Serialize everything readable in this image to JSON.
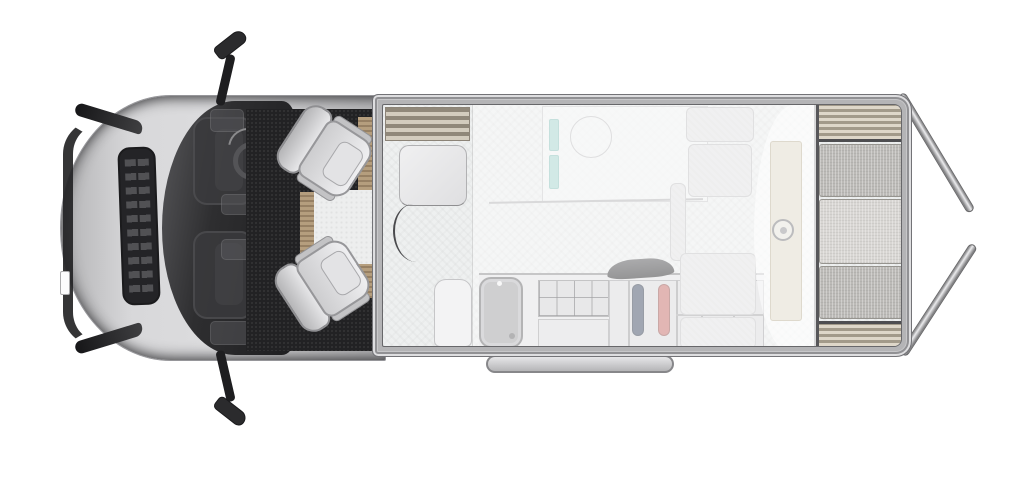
{
  "meta": {
    "description": "Top-down floor plan of a campervan motorhome, front facing left, rear doors open on the right"
  },
  "palette": {
    "background": "#ffffff",
    "body_frame": "#b4b4b6",
    "cab_silver": "#d3d3d5",
    "glass_dark": "#2a2a2c",
    "carpet_dark": "#222224",
    "floor_light": "#eef0f0",
    "furniture_light": "#e7e7e8",
    "wood_tan": "#b59e7e",
    "shelf_wood": "#c6bfb1",
    "mattress_gray": "#bcbab7",
    "mattress_light": "#d8d6d3",
    "teal_accent": "#a9d6d1",
    "blue_accent": "#445068",
    "red_accent": "#c9706c",
    "cream_panel": "#efece4",
    "overlay_white": "rgba(252,252,252,0.5)"
  },
  "regions": {
    "cab": "driver cab with two swivel seats facing the lounge",
    "lounge": "front lounge with table and curved bench",
    "entry": "side entry door step with wooden treads",
    "bathroom": "washroom with shower ring and teal rails",
    "kitchen": "kitchen block with sink, two-zone hob and storage cabinet",
    "gas_locker": "locker with blue and red bottles",
    "bedroom": "rear bed with mattress sections and wood shelves",
    "drop_down_bed": "translucent drop-down bed overlay with roof fan",
    "rear_doors": "rear doors shown open",
    "exterior_step": "sliding entry step under the body",
    "mirrors": "side mirrors extended"
  }
}
